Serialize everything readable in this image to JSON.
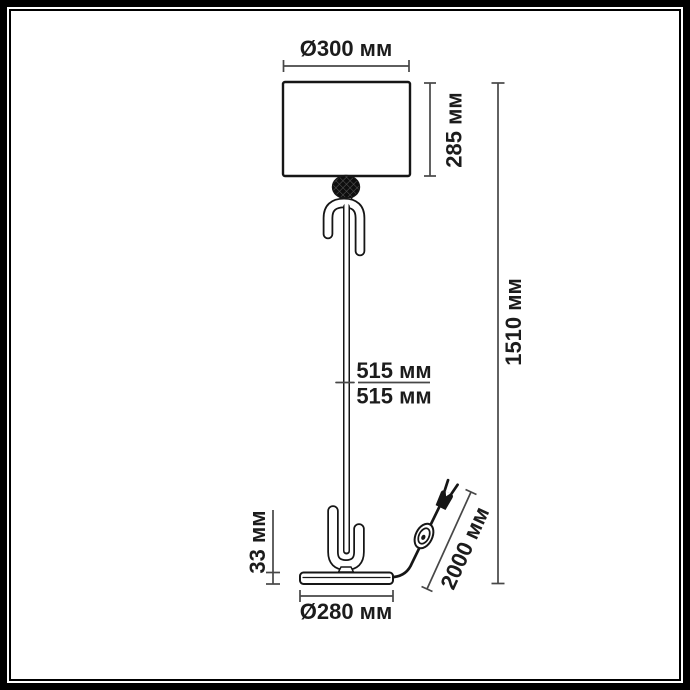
{
  "diagram": {
    "type": "floor-lamp-dimension-drawing",
    "unit": "мм",
    "labels": {
      "shade_diameter": "Ø300 мм",
      "shade_height": "285 мм",
      "total_height": "1510 мм",
      "stem_upper": "515 мм",
      "stem_lower": "515 мм",
      "base_height": "33 мм",
      "base_diameter": "Ø280 мм",
      "cord_length": "2000 мм"
    },
    "colors": {
      "frame": "#000000",
      "drawing_line": "#161616",
      "dimension_line": "#474747",
      "text": "#1c1c1c",
      "background": "#ffffff"
    }
  }
}
